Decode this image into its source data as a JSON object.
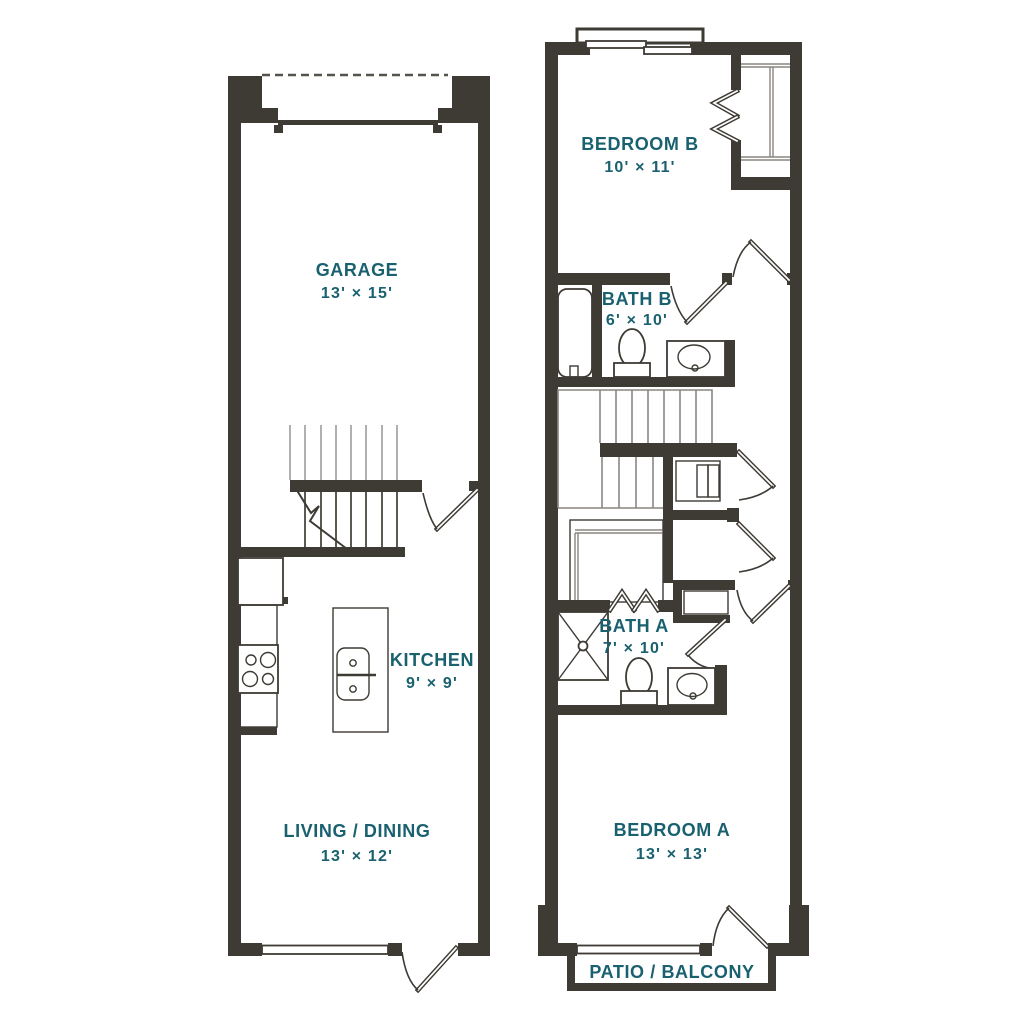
{
  "title": "Two-level townhome floor plan",
  "palette": {
    "wall": "#3e3a34",
    "accent_text": "#1a6170",
    "stair_line": "#8a8680",
    "background": "#ffffff"
  },
  "floor1": {
    "rooms": [
      {
        "id": "garage",
        "label": "GARAGE",
        "dims": "13' × 15'"
      },
      {
        "id": "kitchen",
        "label": "KITCHEN",
        "dims": "9' × 9'"
      },
      {
        "id": "living-dining",
        "label": "LIVING / DINING",
        "dims": "13' × 12'"
      }
    ],
    "fixtures": [
      "garage-door",
      "stairs",
      "refrigerator",
      "range",
      "island-sink",
      "entry-door",
      "window",
      "patio-door"
    ]
  },
  "floor2": {
    "rooms": [
      {
        "id": "bedroom-b",
        "label": "BEDROOM B",
        "dims": "10' × 11'"
      },
      {
        "id": "bath-b",
        "label": "BATH B",
        "dims": "6' × 10'"
      },
      {
        "id": "bath-a",
        "label": "BATH A",
        "dims": "7' × 10'"
      },
      {
        "id": "bedroom-a",
        "label": "BEDROOM A",
        "dims": "13' × 13'"
      }
    ],
    "patio": {
      "label": "PATIO / BALCONY"
    },
    "fixtures": [
      "bay-window",
      "closet-shelves",
      "bifold-doors",
      "bathtub",
      "toilet",
      "vanity-sink",
      "stairs",
      "washer-dryer",
      "shower",
      "bedroom-doors",
      "balcony-door",
      "window"
    ]
  }
}
